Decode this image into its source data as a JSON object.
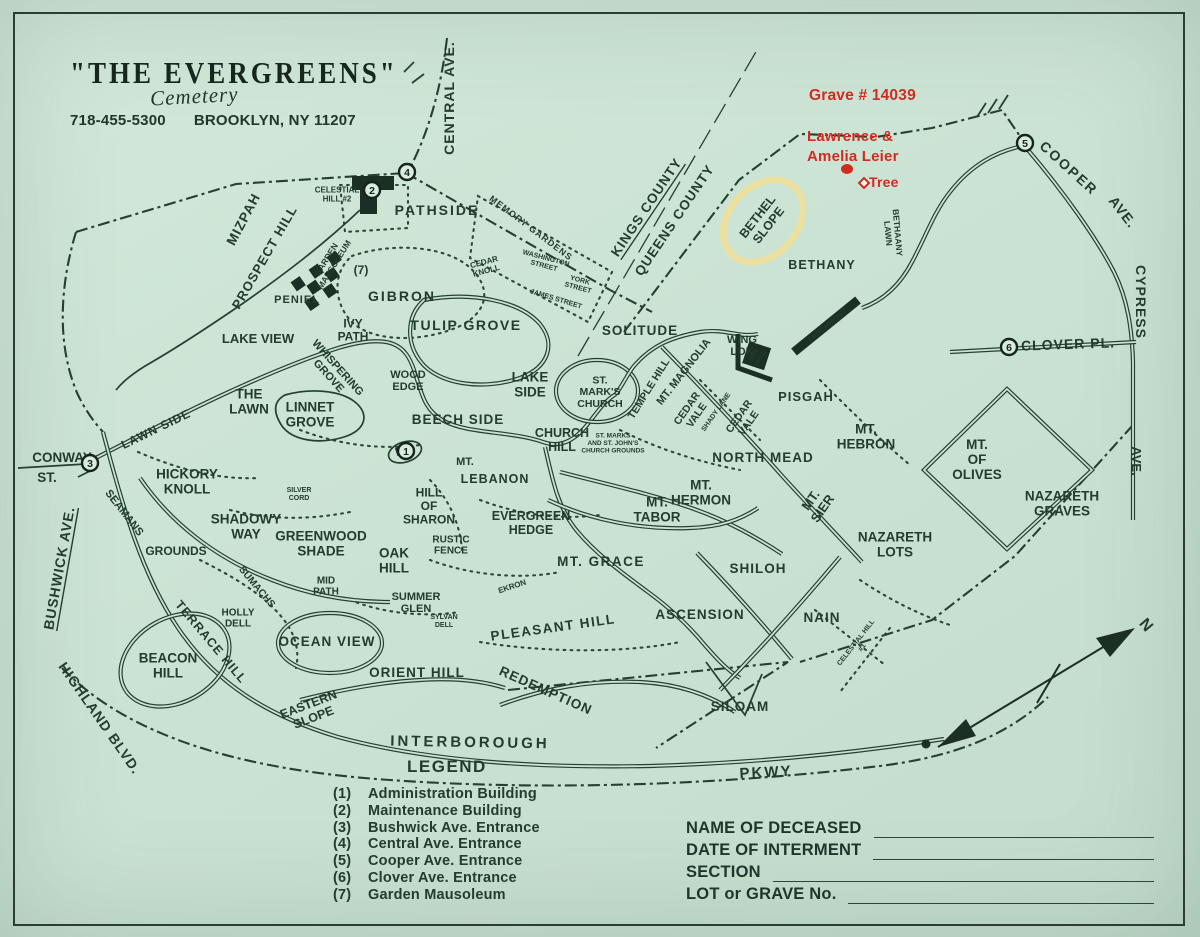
{
  "colors": {
    "paper": "#cbe3d4",
    "ink": "#24402f",
    "red": "#d22b1f",
    "highlight": "#ecdf9d"
  },
  "header": {
    "title": "\"THE EVERGREENS\"",
    "subtitle": "Cemetery",
    "phone": "718-455-5300",
    "address": "BROOKLYN, NY 11207"
  },
  "annotations": {
    "grave": "Grave # 14039",
    "name_line1": "Lawrence &",
    "name_line2": "Amelia Leier",
    "tree": "Tree"
  },
  "legend": {
    "title": "LEGEND",
    "items": [
      {
        "num": "(1)",
        "label": "Administration Building"
      },
      {
        "num": "(2)",
        "label": "Maintenance Building"
      },
      {
        "num": "(3)",
        "label": "Bushwick Ave. Entrance"
      },
      {
        "num": "(4)",
        "label": "Central Ave. Entrance"
      },
      {
        "num": "(5)",
        "label": "Cooper Ave. Entrance"
      },
      {
        "num": "(6)",
        "label": "Clover Ave. Entrance"
      },
      {
        "num": "(7)",
        "label": "Garden Mausoleum"
      }
    ]
  },
  "form": {
    "fields": [
      "NAME OF DECEASED",
      "DATE OF INTERMENT",
      "SECTION",
      "LOT or GRAVE No."
    ]
  },
  "entrance_markers": [
    {
      "n": "1",
      "x": 406,
      "y": 451
    },
    {
      "n": "2",
      "x": 372,
      "y": 190
    },
    {
      "n": "3",
      "x": 90,
      "y": 463
    },
    {
      "n": "4",
      "x": 407,
      "y": 172
    },
    {
      "n": "5",
      "x": 1025,
      "y": 143
    },
    {
      "n": "6",
      "x": 1009,
      "y": 347
    }
  ],
  "map_labels": [
    {
      "t": "CENTRAL AVE.",
      "x": 449,
      "y": 98,
      "r": -90,
      "s": 14,
      "ls": 1
    },
    {
      "t": "COOPER",
      "x": 1069,
      "y": 168,
      "r": 42,
      "s": 14,
      "ls": 2
    },
    {
      "t": "AVE.",
      "x": 1123,
      "y": 212,
      "r": 52,
      "s": 14,
      "ls": 1
    },
    {
      "t": "CYPRESS",
      "x": 1141,
      "y": 302,
      "r": 90,
      "s": 14,
      "ls": 1
    },
    {
      "t": "AVE.",
      "x": 1137,
      "y": 461,
      "r": 90,
      "s": 13
    },
    {
      "t": "CLOVER PL.",
      "x": 1068,
      "y": 344,
      "r": -2,
      "s": 14,
      "ls": 1
    },
    {
      "t": "KINGS COUNTY",
      "x": 646,
      "y": 207,
      "r": -56,
      "s": 13.5,
      "ls": 1,
      "u": true
    },
    {
      "t": "QUEENS COUNTY",
      "x": 674,
      "y": 220,
      "r": -56,
      "s": 13.5,
      "ls": 1
    },
    {
      "t": "CONWAY",
      "x": 62,
      "y": 457,
      "s": 13.5
    },
    {
      "t": "ST.",
      "x": 47,
      "y": 477,
      "s": 13.5
    },
    {
      "t": "BUSHWICK AVE.",
      "x": 59,
      "y": 568,
      "r": -80,
      "s": 14,
      "ls": 1,
      "u": true
    },
    {
      "t": "HIGHLAND BLVD.",
      "x": 100,
      "y": 718,
      "r": 55,
      "s": 14,
      "ls": 1
    },
    {
      "t": "LAWN SIDE",
      "x": 156,
      "y": 429,
      "r": -26,
      "s": 12,
      "ls": 1
    },
    {
      "t": "INTERBOROUGH",
      "x": 470,
      "y": 742,
      "r": 1,
      "s": 15,
      "ls": 3
    },
    {
      "t": "PKWY",
      "x": 766,
      "y": 772,
      "r": -3,
      "s": 15,
      "ls": 2
    },
    {
      "t": "MIZPAH",
      "x": 243,
      "y": 219,
      "r": -62,
      "s": 13.5,
      "ls": 1
    },
    {
      "t": "PROSPECT HILL",
      "x": 264,
      "y": 257,
      "r": -60,
      "s": 13,
      "ls": 1
    },
    {
      "lines": [
        "CELESTIAL",
        "HILL #2"
      ],
      "x": 337,
      "y": 194,
      "s": 8
    },
    {
      "t": "PATHSIDE",
      "x": 437,
      "y": 210,
      "s": 14,
      "ls": 2
    },
    {
      "t": "MEMORY GARDENS",
      "x": 531,
      "y": 228,
      "r": 37,
      "s": 9,
      "ls": 1
    },
    {
      "lines": [
        "WASHINGTON",
        "STREET"
      ],
      "x": 545,
      "y": 262,
      "r": 15,
      "s": 7
    },
    {
      "lines": [
        "YORK",
        "STREET"
      ],
      "x": 579,
      "y": 284,
      "r": 15,
      "s": 7
    },
    {
      "t": "JAMES STREET",
      "x": 556,
      "y": 299,
      "r": 17,
      "s": 7
    },
    {
      "lines": [
        "CEDAR",
        "KNOLL"
      ],
      "x": 485,
      "y": 266,
      "r": -15,
      "s": 8
    },
    {
      "t": "GIBRON",
      "x": 402,
      "y": 296,
      "s": 14,
      "ls": 2
    },
    {
      "t": "PENIEL",
      "x": 297,
      "y": 300,
      "s": 11,
      "ls": 1
    },
    {
      "lines": [
        "GARDEN",
        "MAUSOLEUM"
      ],
      "x": 330,
      "y": 262,
      "r": -58,
      "s": 8.5
    },
    {
      "t": "(7)",
      "x": 361,
      "y": 270,
      "s": 12,
      "w": 700
    },
    {
      "lines": [
        "IVY",
        "PATH"
      ],
      "x": 353,
      "y": 330,
      "s": 12
    },
    {
      "t": "TULIP GROVE",
      "x": 466,
      "y": 325,
      "s": 14,
      "ls": 1.5
    },
    {
      "t": "LAKE VIEW",
      "x": 258,
      "y": 338,
      "s": 13
    },
    {
      "lines": [
        "WHISPERING",
        "GROVE"
      ],
      "x": 333,
      "y": 372,
      "r": 48,
      "s": 11
    },
    {
      "lines": [
        "WOOD",
        "EDGE"
      ],
      "x": 408,
      "y": 381,
      "s": 11
    },
    {
      "lines": [
        "THE",
        "LAWN"
      ],
      "x": 249,
      "y": 401,
      "s": 13.5
    },
    {
      "lines": [
        "LINNET",
        "GROVE"
      ],
      "x": 310,
      "y": 414,
      "s": 13.5
    },
    {
      "t": "BEECH SIDE",
      "x": 458,
      "y": 419,
      "s": 13.5,
      "ls": 1
    },
    {
      "lines": [
        "LAKE",
        "SIDE"
      ],
      "x": 530,
      "y": 384,
      "s": 13.5
    },
    {
      "lines": [
        "ST.",
        "MARK'S",
        "CHURCH"
      ],
      "x": 600,
      "y": 392,
      "s": 10.5
    },
    {
      "t": "SOLITUDE",
      "x": 640,
      "y": 330,
      "s": 13.5,
      "ls": 1
    },
    {
      "t": "MT. MAGNOLIA",
      "x": 684,
      "y": 372,
      "r": -52,
      "s": 11
    },
    {
      "t": "TEMPLE HILL",
      "x": 649,
      "y": 389,
      "r": -58,
      "s": 10.5
    },
    {
      "lines": [
        "WING",
        "LOK"
      ],
      "x": 742,
      "y": 346,
      "s": 11
    },
    {
      "lines": [
        "SYR",
        "ORTH"
      ],
      "x": 757,
      "y": 357,
      "r": -55,
      "s": 6.5,
      "fill": "#cbe3d4"
    },
    {
      "lines": [
        "BETHEL",
        "SLOPE"
      ],
      "x": 763,
      "y": 221,
      "r": -52,
      "s": 12.5
    },
    {
      "t": "BETHANY",
      "x": 822,
      "y": 265,
      "s": 12.5,
      "ls": 1
    },
    {
      "lines": [
        "BETHAANY",
        "LAWN"
      ],
      "x": 893,
      "y": 233,
      "r": 85,
      "s": 8.5
    },
    {
      "t": "LARCHMONT",
      "x": 827,
      "y": 325,
      "r": -39,
      "s": 7.5,
      "fill": "#cbe3d4"
    },
    {
      "t": "PISGAH",
      "x": 806,
      "y": 396,
      "s": 13,
      "ls": 1
    },
    {
      "lines": [
        "CEDAR",
        "VALE"
      ],
      "x": 692,
      "y": 412,
      "r": -55,
      "s": 10.5
    },
    {
      "t": "SHADY LANE",
      "x": 716,
      "y": 412,
      "r": -55,
      "s": 7
    },
    {
      "lines": [
        "CEDAR",
        "VALE"
      ],
      "x": 744,
      "y": 420,
      "r": -55,
      "s": 10.5
    },
    {
      "t": "NORTH MEAD",
      "x": 763,
      "y": 457,
      "s": 13.5,
      "ls": 1
    },
    {
      "lines": [
        "MT.",
        "HEBRON"
      ],
      "x": 866,
      "y": 436,
      "s": 13.5
    },
    {
      "lines": [
        "MT.",
        "HERMON"
      ],
      "x": 701,
      "y": 492,
      "s": 13.5
    },
    {
      "lines": [
        "MT.",
        "SIER"
      ],
      "x": 816,
      "y": 504,
      "r": -55,
      "s": 13
    },
    {
      "lines": [
        "MT.",
        "OF",
        "OLIVES"
      ],
      "x": 977,
      "y": 459,
      "s": 13.5
    },
    {
      "lines": [
        "NAZARETH",
        "GRAVES"
      ],
      "x": 1062,
      "y": 503,
      "s": 13.5
    },
    {
      "lines": [
        "NAZARETH",
        "LOTS"
      ],
      "x": 895,
      "y": 544,
      "s": 13.5
    },
    {
      "lines": [
        "CHURCH",
        "HILL"
      ],
      "x": 562,
      "y": 440,
      "s": 12.5
    },
    {
      "t": "MT.",
      "x": 465,
      "y": 462,
      "s": 11
    },
    {
      "t": "LEBANON",
      "x": 495,
      "y": 479,
      "s": 12.5,
      "ls": 1
    },
    {
      "lines": [
        "ST. MARKS",
        "AND ST. JOHN'S",
        "CHURCH GROUNDS"
      ],
      "x": 613,
      "y": 443,
      "s": 6.5
    },
    {
      "lines": [
        "EVERGREEN",
        "HEDGE"
      ],
      "x": 531,
      "y": 523,
      "s": 12.5
    },
    {
      "lines": [
        "MT.",
        "TABOR"
      ],
      "x": 657,
      "y": 509,
      "s": 13.5
    },
    {
      "t": "MT. GRACE",
      "x": 601,
      "y": 561,
      "s": 13.5,
      "ls": 1.5
    },
    {
      "lines": [
        "HICKORY",
        "KNOLL"
      ],
      "x": 187,
      "y": 481,
      "s": 13.5
    },
    {
      "t": "SEAMANS",
      "x": 124,
      "y": 513,
      "r": 52,
      "s": 11
    },
    {
      "t": "GROUNDS",
      "x": 176,
      "y": 551,
      "s": 12
    },
    {
      "lines": [
        "SHADOWY",
        "WAY"
      ],
      "x": 246,
      "y": 526,
      "s": 13.5
    },
    {
      "lines": [
        "GREENWOOD",
        "SHADE"
      ],
      "x": 321,
      "y": 543,
      "s": 13.5
    },
    {
      "lines": [
        "SILVER",
        "CORD"
      ],
      "x": 299,
      "y": 494,
      "s": 7
    },
    {
      "lines": [
        "HILL",
        "OF",
        "SHARON"
      ],
      "x": 429,
      "y": 506,
      "s": 12
    },
    {
      "lines": [
        "OAK",
        "HILL"
      ],
      "x": 394,
      "y": 560,
      "s": 13.5
    },
    {
      "lines": [
        "RUSTIC",
        "FENCE"
      ],
      "x": 451,
      "y": 545,
      "s": 10
    },
    {
      "lines": [
        "MID",
        "PATH"
      ],
      "x": 326,
      "y": 586,
      "s": 10
    },
    {
      "t": "SUMACHS",
      "x": 257,
      "y": 587,
      "r": 50,
      "s": 10
    },
    {
      "lines": [
        "HOLLY",
        "DELL"
      ],
      "x": 238,
      "y": 618,
      "s": 10
    },
    {
      "t": "OCEAN VIEW",
      "x": 327,
      "y": 641,
      "s": 13.5,
      "ls": 1
    },
    {
      "t": "TERRACE HILL",
      "x": 211,
      "y": 642,
      "r": 50,
      "s": 12.5,
      "ls": 1
    },
    {
      "lines": [
        "BEACON",
        "HILL"
      ],
      "x": 168,
      "y": 665,
      "s": 13.5
    },
    {
      "lines": [
        "SUMMER",
        "GLEN"
      ],
      "x": 416,
      "y": 603,
      "s": 11
    },
    {
      "lines": [
        "SYLVAN",
        "DELL"
      ],
      "x": 444,
      "y": 621,
      "s": 7
    },
    {
      "t": "EKRON",
      "x": 512,
      "y": 586,
      "r": -18,
      "s": 8
    },
    {
      "t": "PLEASANT HILL",
      "x": 553,
      "y": 627,
      "r": -8,
      "s": 13.5,
      "ls": 1.5
    },
    {
      "t": "ORIENT HILL",
      "x": 417,
      "y": 672,
      "s": 13.5,
      "ls": 1
    },
    {
      "t": "REDEMPTION",
      "x": 546,
      "y": 690,
      "r": 24,
      "s": 13.5,
      "ls": 1
    },
    {
      "lines": [
        "EASTERN",
        "SLOPE"
      ],
      "x": 311,
      "y": 711,
      "r": -21,
      "s": 12.5
    },
    {
      "t": "ASCENSION",
      "x": 700,
      "y": 614,
      "s": 13.5,
      "ls": 1
    },
    {
      "t": "SHILOH",
      "x": 758,
      "y": 568,
      "s": 13.5,
      "ls": 1
    },
    {
      "t": "NAIN",
      "x": 822,
      "y": 617,
      "s": 13.5,
      "ls": 1
    },
    {
      "t": "SILOAM",
      "x": 740,
      "y": 706,
      "s": 13.5,
      "ls": 1
    },
    {
      "lines": [
        "CELESTIAL HILL",
        "#1"
      ],
      "x": 859,
      "y": 645,
      "r": -52,
      "s": 7
    },
    {
      "t": "N",
      "x": 1146,
      "y": 625,
      "r": 50,
      "s": 16,
      "w": 700
    }
  ]
}
